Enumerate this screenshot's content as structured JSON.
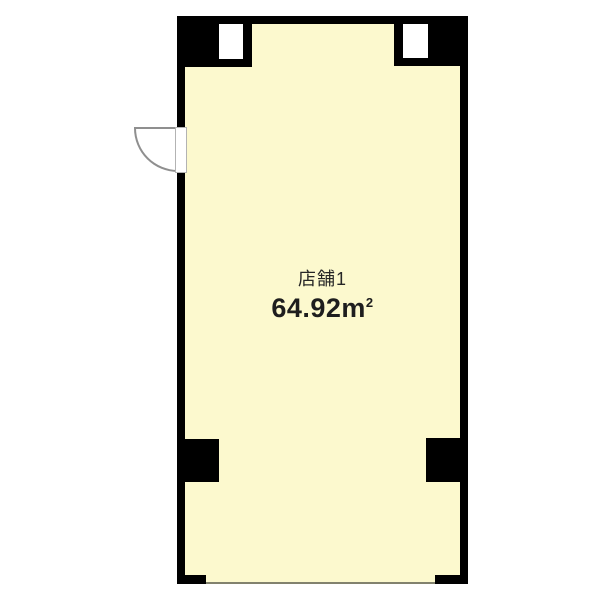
{
  "floorplan": {
    "room": {
      "name": "店舗1",
      "area_value": "64.92",
      "area_unit_base": "m",
      "area_unit_sup": "2"
    },
    "colors": {
      "floor_fill": "#fcf9ce",
      "wall": "#000000",
      "opening_line": "#82826e",
      "door_line": "#8f8f8f",
      "door_frame": "#b3b3b3",
      "text": "#262626",
      "page_bg": "#ffffff"
    },
    "features": {
      "windows": [
        "top-left-window",
        "top-right-window"
      ],
      "pillars": [
        "left-pillar",
        "right-pillar"
      ],
      "door": "left-wall-swing-door",
      "storefront": "open-bottom-edge"
    }
  }
}
